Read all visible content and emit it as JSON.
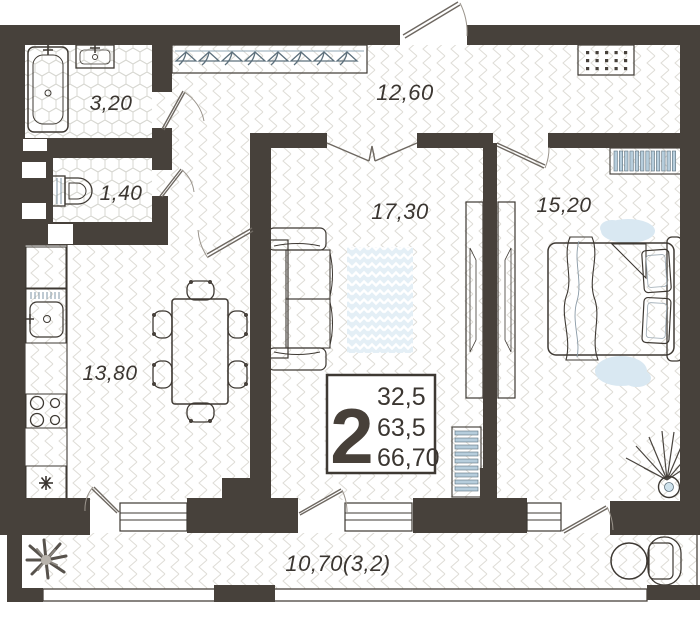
{
  "floor_plan": {
    "room_labels": {
      "bathroom": "3,20",
      "wc": "1,40",
      "hallway": "12,60",
      "living_room": "17,30",
      "bedroom": "15,20",
      "kitchen": "13,80",
      "balcony": "10,70(3,2)"
    },
    "info_box": {
      "rooms_count": "2",
      "living_area": "32,5",
      "area_without_balcony": "63,5",
      "total_area": "66,70"
    },
    "colors": {
      "wall": "#47413b",
      "furniture_light": "#cfe2ec",
      "furniture_medium": "#a9c6d8",
      "furniture_dark": "#8fb3ca",
      "floor_line": "#dcdad4",
      "label_text": "#3b3631"
    }
  }
}
